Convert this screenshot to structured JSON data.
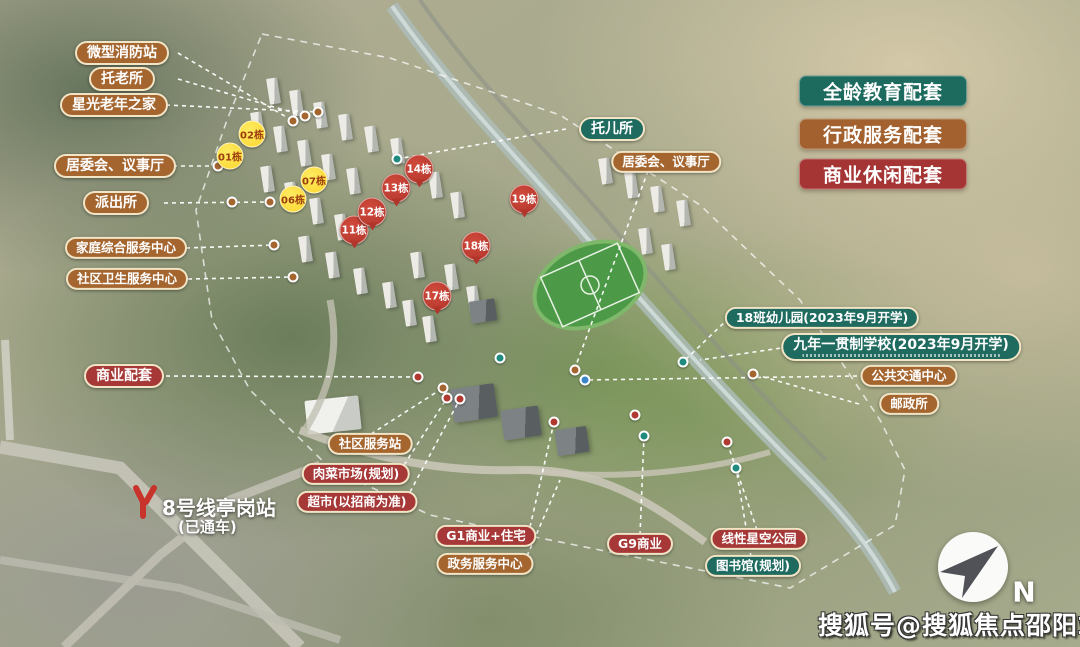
{
  "legend": [
    {
      "text": "全龄教育配套",
      "color": "#1d6a5e"
    },
    {
      "text": "行政服务配套",
      "color": "#a2612e"
    },
    {
      "text": "商业休闲配套",
      "color": "#a43534"
    }
  ],
  "callouts": [
    {
      "id": "micro-fire-station",
      "text": "微型消防站",
      "category": "admin"
    },
    {
      "id": "elder-care-home",
      "text": "托老所",
      "category": "admin"
    },
    {
      "id": "starlight-senior-home",
      "text": "星光老年之家",
      "category": "admin"
    },
    {
      "id": "committee-hall-left",
      "text": "居委会、议事厅",
      "category": "admin"
    },
    {
      "id": "police-station",
      "text": "派出所",
      "category": "admin"
    },
    {
      "id": "family-service-center",
      "text": "家庭综合服务中心",
      "category": "admin"
    },
    {
      "id": "community-health-center",
      "text": "社区卫生服务中心",
      "category": "admin"
    },
    {
      "id": "commercial-support",
      "text": "商业配套",
      "category": "commercial"
    },
    {
      "id": "nursery",
      "text": "托儿所",
      "category": "education"
    },
    {
      "id": "committee-hall-right",
      "text": "居委会、议事厅",
      "category": "admin"
    },
    {
      "id": "kindergarten-18-class",
      "text": "18班幼儿园(2023年9月开学)",
      "category": "education"
    },
    {
      "id": "nine-year-school",
      "text": "九年一贯制学校(2023年9月开学)",
      "category": "education"
    },
    {
      "id": "public-transport-center",
      "text": "公共交通中心",
      "category": "admin"
    },
    {
      "id": "post-office",
      "text": "邮政所",
      "category": "admin"
    },
    {
      "id": "community-service-station",
      "text": "社区服务站",
      "category": "admin"
    },
    {
      "id": "meat-vegetable-market",
      "text": "肉菜市场(规划)",
      "category": "commercial"
    },
    {
      "id": "supermarket",
      "text": "超市(以招商为准)",
      "category": "commercial"
    },
    {
      "id": "g1-commercial-residential",
      "text": "G1商业+住宅",
      "category": "commercial"
    },
    {
      "id": "government-service-center",
      "text": "政务服务中心",
      "category": "admin"
    },
    {
      "id": "g9-commercial",
      "text": "G9商业",
      "category": "commercial"
    },
    {
      "id": "linear-star-park",
      "text": "线性星空公园",
      "category": "commercial"
    },
    {
      "id": "library-planned",
      "text": "图书馆(规划)",
      "category": "education"
    }
  ],
  "building_badges": {
    "yellow": [
      {
        "text": "01栋"
      },
      {
        "text": "02栋"
      },
      {
        "text": "06栋"
      },
      {
        "text": "07栋"
      }
    ],
    "red": [
      {
        "text": "11栋"
      },
      {
        "text": "12栋"
      },
      {
        "text": "13栋"
      },
      {
        "text": "14栋"
      },
      {
        "text": "17栋"
      },
      {
        "text": "18栋"
      },
      {
        "text": "19栋"
      }
    ]
  },
  "station": {
    "name": "8号线亭岗站",
    "status": "(已通车)"
  },
  "compass": {
    "label": "N"
  },
  "watermark": {
    "text": "搜狐号@搜狐焦点邵阳站"
  },
  "colors": {
    "education": "#1f6b60",
    "admin": "#a5652f",
    "commercial": "#a63938",
    "badge_yellow": "#fbd52e",
    "badge_red": "#b1352b",
    "metro_logo": "#c8332b"
  }
}
